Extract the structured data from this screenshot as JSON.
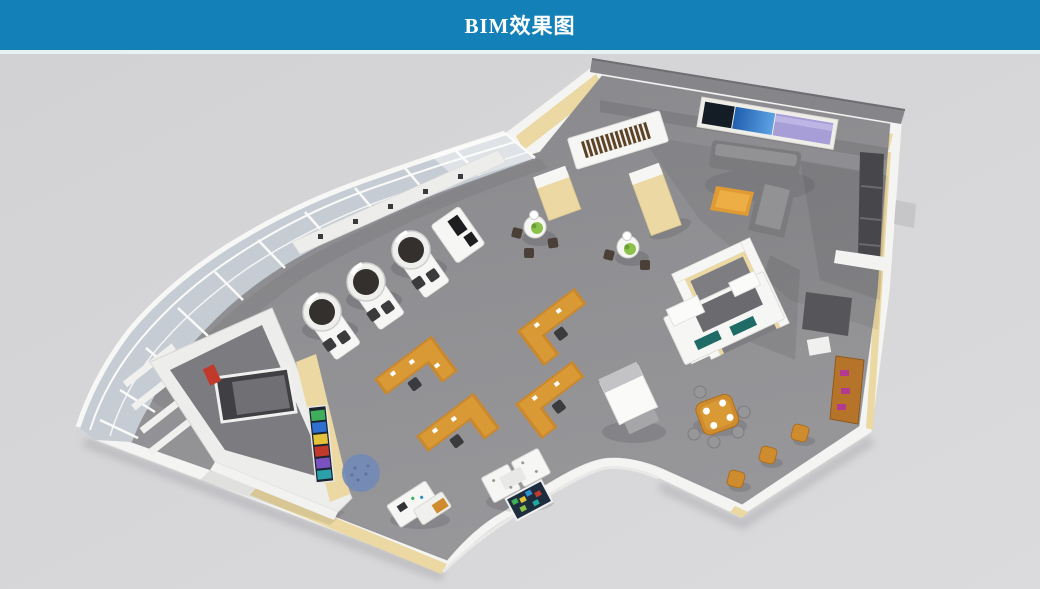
{
  "header": {
    "title": "BIM效果图"
  },
  "palette": {
    "header_bg": "#1480b8",
    "header_text": "#ffffff",
    "header_divider": "#e7f3f1",
    "canvas_bg": "#d2d2d4",
    "canvas_bg_light": "#dbdbdd",
    "floor_gray": "#8e8e90",
    "wall_white": "#f4f4f2",
    "wall_cream": "#ebd8a2",
    "roof_gray": "#85858a",
    "glass_blue_gray": "#c5ccd3",
    "wood_orange": "#c9882e",
    "wood_orange_light": "#d99a36",
    "sofa_gray": "#7b7b7e",
    "screen_dark_navy": "#141c26",
    "screen_blue": "#3c8ad8",
    "screen_lavender": "#a79ed8",
    "plant_green": "#8bc34a",
    "rug_blue": "#7189b6",
    "dark_furniture": "#3b3b3d",
    "teal_screen": "#1f6b66",
    "magenta_accent": "#b23a8f",
    "shadow_tint": "#2e2e36"
  }
}
